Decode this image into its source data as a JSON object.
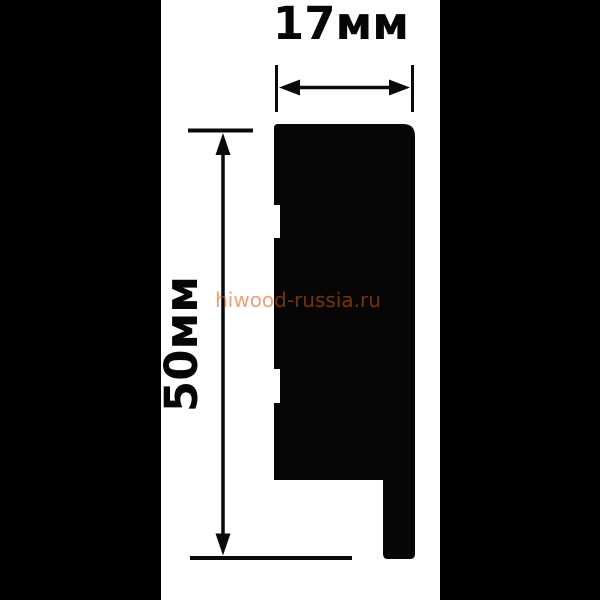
{
  "drawing": {
    "type": "moulding-profile-cross-section",
    "dimensions": {
      "width_label": "17мм",
      "height_label": "50мм"
    },
    "watermark": {
      "text": "hiwood-russia.ru",
      "color": "rgba(218,88,0,0.55)"
    },
    "colors": {
      "pillarbox": "#000000",
      "profile": "#060606",
      "background": "#ffffff",
      "line": "#0a0a0a"
    }
  }
}
